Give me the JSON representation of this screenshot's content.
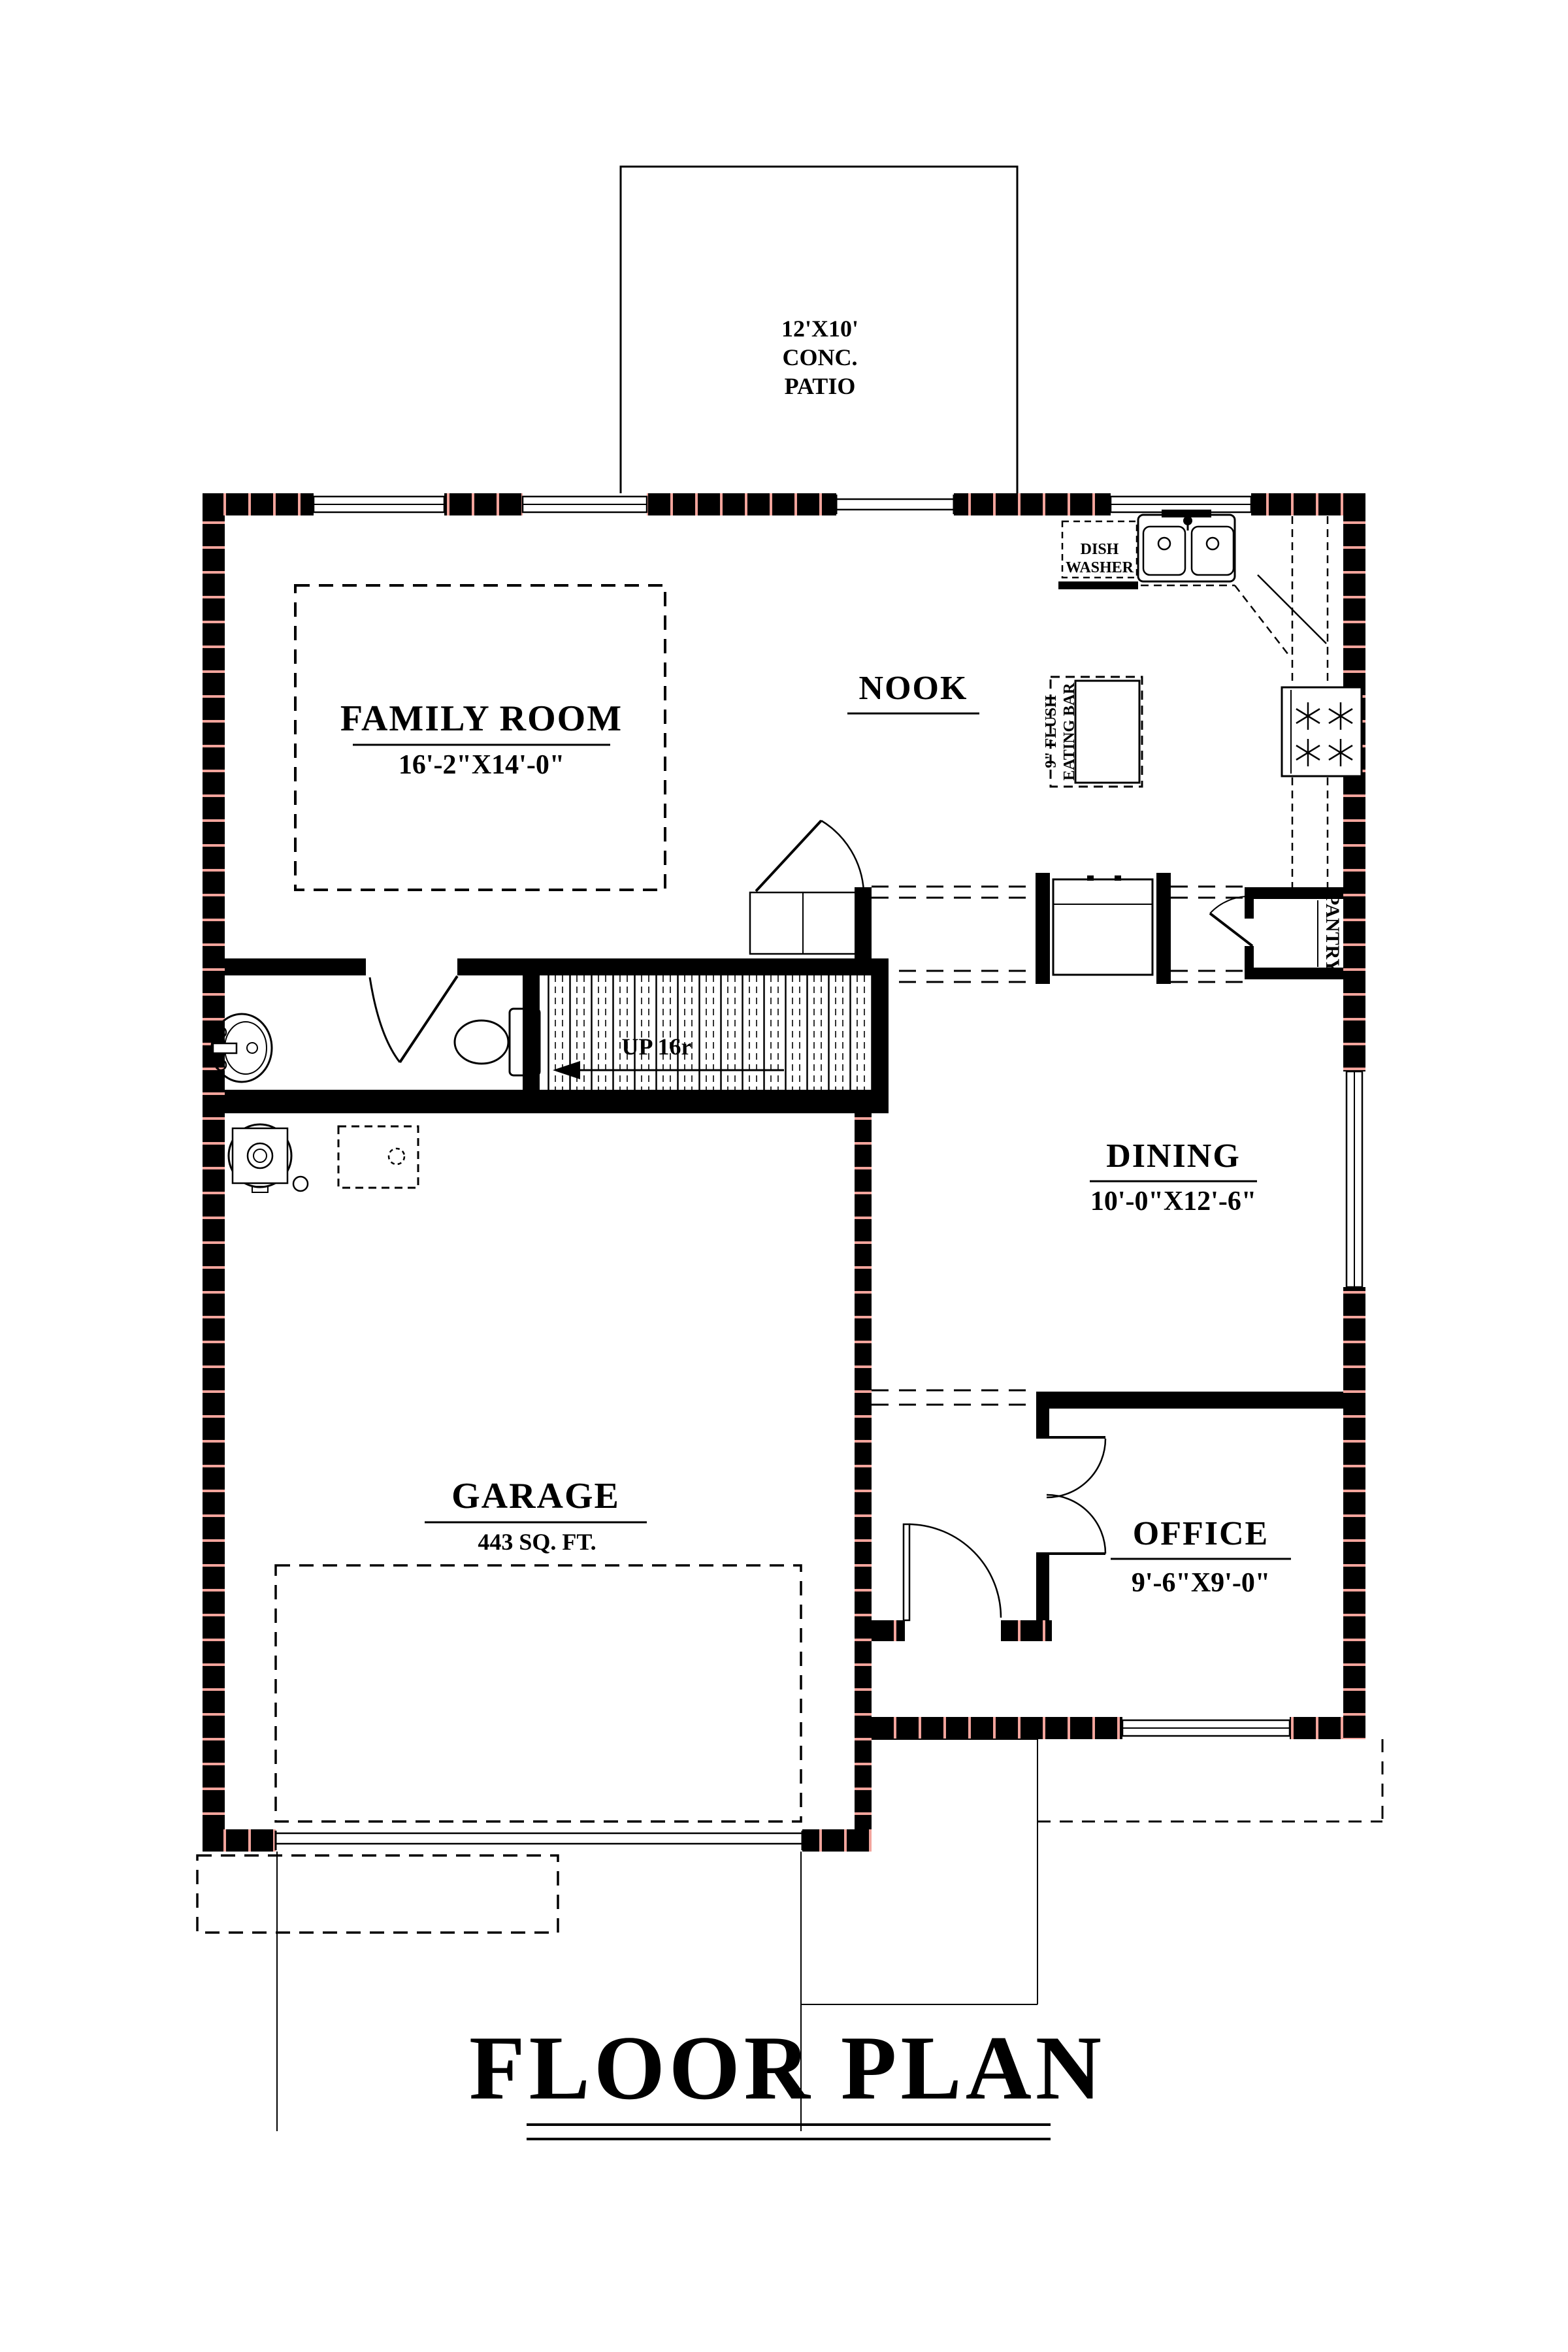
{
  "drawing": {
    "title": "FLOOR PLAN",
    "patio": {
      "line1": "12'X10'",
      "line2": "CONC.",
      "line3": "PATIO"
    },
    "family_room": {
      "name": "FAMILY ROOM",
      "dims": "16'-2\"X14'-0\""
    },
    "nook": {
      "name": "NOOK"
    },
    "dining": {
      "name": "DINING",
      "dims": "10'-0\"X12'-6\""
    },
    "garage": {
      "name": "GARAGE",
      "dims": "443 SQ. FT."
    },
    "office": {
      "name": "OFFICE",
      "dims": "9'-6\"X9'-0\""
    },
    "pantry": {
      "name": "PANTRY"
    },
    "kitchen": {
      "dishwasher_line1": "DISH",
      "dishwasher_line2": "WASHER",
      "eating_bar_line1": "9\" FLUSH",
      "eating_bar_line2": "EATING BAR"
    },
    "stairs": {
      "label": "UP 16r"
    },
    "colors": {
      "line": "#000000",
      "hatch": "#f2a49c",
      "background": "#ffffff"
    }
  }
}
